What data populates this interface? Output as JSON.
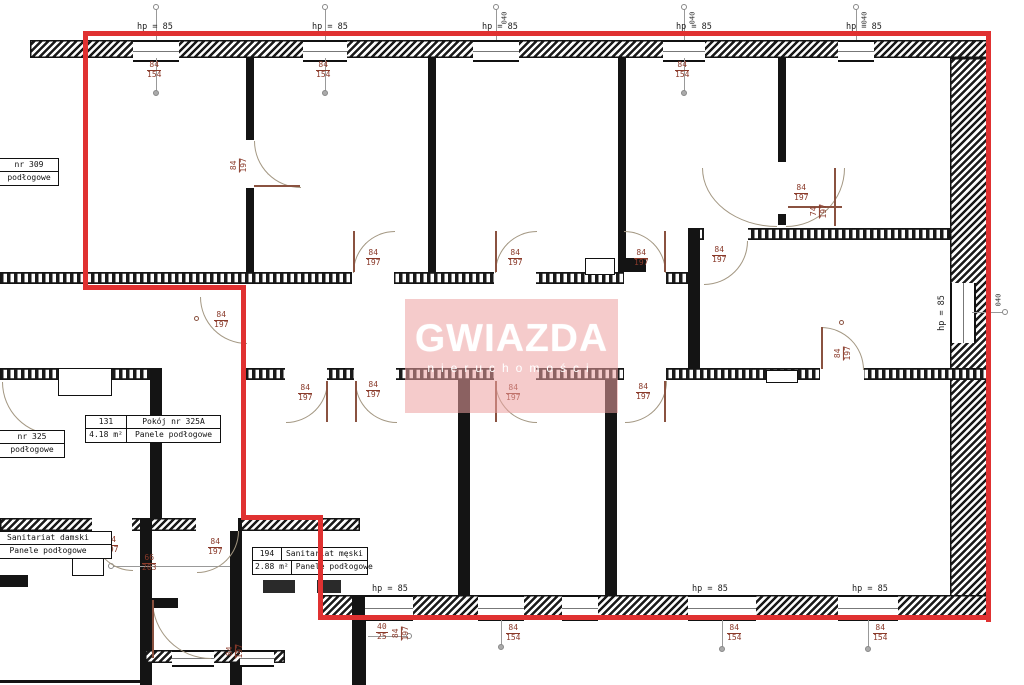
{
  "watermark": {
    "title": "GWIAZDA",
    "subtitle": "nieruchomości"
  },
  "dims": {
    "hp85": "hp = 85",
    "m040": "040"
  },
  "door_labels": {
    "d84_197": {
      "num": "84",
      "den": "197"
    },
    "d74_197": {
      "num": "74",
      "den": "197"
    },
    "d66_203": {
      "num": "66",
      "den": "203"
    },
    "d40_25": {
      "num": "40",
      "den": "25"
    },
    "w84_154": {
      "num": "84",
      "den": "154"
    }
  },
  "rooms": {
    "r309": {
      "name": "nr 309",
      "floor": "podłogowe"
    },
    "r325": {
      "name": "nr 325",
      "floor": "podłogowe"
    },
    "r325a": {
      "id": "131",
      "name": "Pokój nr 325A",
      "area": "4.18 m²",
      "floor": "Panele podłogowe"
    },
    "damski": {
      "name": "Sanitariat damski",
      "floor": "Panele podłogowe"
    },
    "meski": {
      "id": "194",
      "name": "Sanitariat męski",
      "area": "2.88 m²",
      "floor": "Panele podłogowe"
    }
  },
  "colors": {
    "outline": "#e03131",
    "annotation": "#8a3a2a",
    "wall": "#141414",
    "watermark_bg": "#eca0a0"
  }
}
